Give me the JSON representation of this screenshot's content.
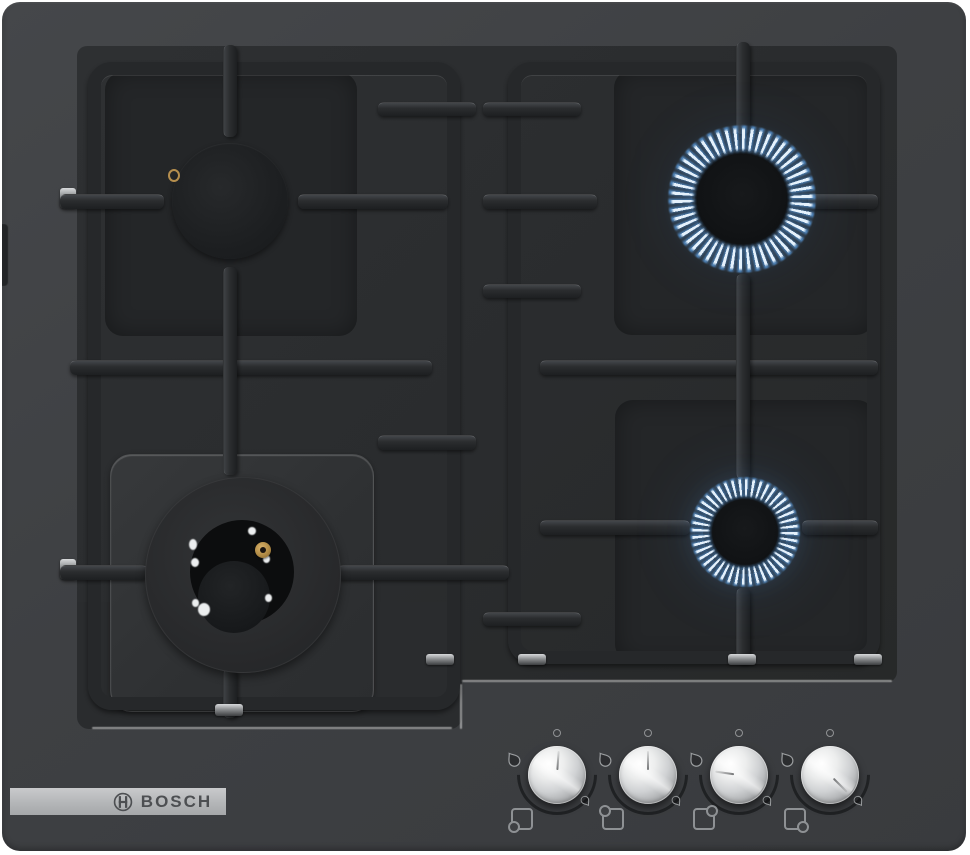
{
  "product": {
    "brand": "BOSCH",
    "category": "gas hob with 4 burners"
  },
  "logo": {
    "text": "BOSCH",
    "symbol_icon": "bosch-circle-h-icon",
    "strip_color": "#b9babc",
    "text_color": "#4d4f52"
  },
  "colors": {
    "background": "#ffffff",
    "body": "#3e4043",
    "glass": "#2a2c2e",
    "grate": "#26282a",
    "burner_cap": "#1d1f21",
    "flame_blue": "#5a9bdc",
    "flame_core": "#ebf6ff",
    "knob_metal": "#d9dadc",
    "igniter_brass": "#b08a45"
  },
  "burners": [
    {
      "name": "top-left-burner",
      "size": "standard",
      "state": "off"
    },
    {
      "name": "top-right-burner",
      "size": "large",
      "state": "on"
    },
    {
      "name": "bottom-left-wok-burner",
      "size": "wok",
      "state": "off"
    },
    {
      "name": "bottom-right-burner",
      "size": "standard",
      "state": "on"
    }
  ],
  "knobs": [
    {
      "name": "knob-1",
      "controls": "bottom-left-wok-burner",
      "state": "off",
      "pointer_deg": 4,
      "icons": [
        "off-dot-icon",
        "flame-high-icon",
        "flame-low-icon",
        "burner-position-bottom-left-icon"
      ]
    },
    {
      "name": "knob-2",
      "controls": "top-left-burner",
      "state": "off",
      "pointer_deg": 0,
      "icons": [
        "off-dot-icon",
        "flame-high-icon",
        "flame-low-icon",
        "burner-position-top-left-icon"
      ]
    },
    {
      "name": "knob-3",
      "controls": "top-right-burner",
      "state": "on-high",
      "pointer_deg": 278,
      "icons": [
        "off-dot-icon",
        "flame-high-icon",
        "flame-low-icon",
        "burner-position-top-right-icon"
      ]
    },
    {
      "name": "knob-4",
      "controls": "bottom-right-burner",
      "state": "on-low",
      "pointer_deg": 135,
      "icons": [
        "off-dot-icon",
        "flame-high-icon",
        "flame-low-icon",
        "burner-position-bottom-right-icon"
      ]
    }
  ]
}
